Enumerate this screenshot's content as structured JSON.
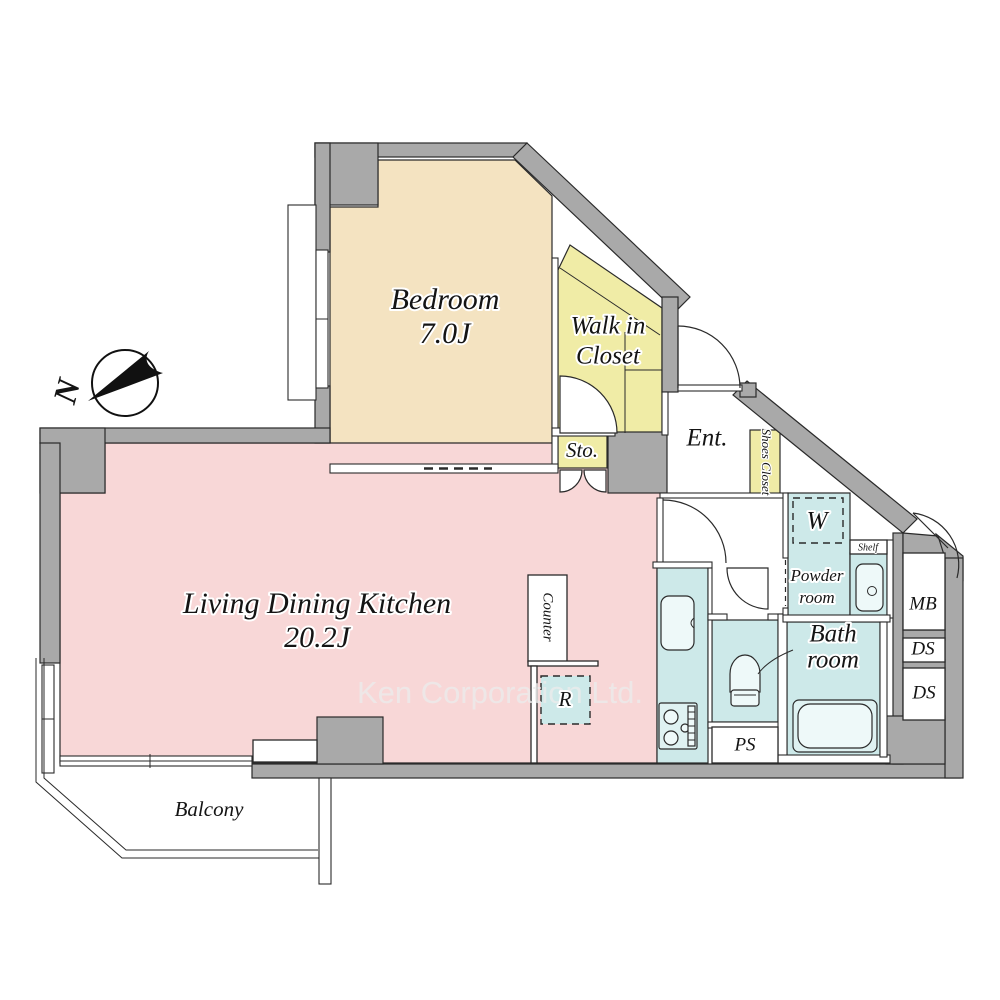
{
  "watermark": {
    "text": "Ken Corporation Ltd."
  },
  "compass": {
    "label": "N"
  },
  "rooms": {
    "bedroom": {
      "name": "Bedroom",
      "size": "7.0J"
    },
    "walk_in_closet": {
      "line1": "Walk in",
      "line2": "Closet"
    },
    "storage": {
      "label": "Sto."
    },
    "entrance": {
      "label": "Ent."
    },
    "shoes_closet": {
      "label": "Shoes Closet"
    },
    "washing_machine": {
      "label": "W"
    },
    "shelf": {
      "label": "Shelf"
    },
    "powder_room": {
      "line1": "Powder",
      "line2": "room"
    },
    "bathroom": {
      "line1": "Bath",
      "line2": "room"
    },
    "meter_box": {
      "label": "MB"
    },
    "duct_space_1": {
      "label": "DS"
    },
    "duct_space_2": {
      "label": "DS"
    },
    "pipe_space": {
      "label": "PS"
    },
    "counter": {
      "label": "Counter"
    },
    "refrigerator": {
      "label": "R"
    },
    "ldk": {
      "name": "Living Dining Kitchen",
      "size": "20.2J"
    },
    "balcony": {
      "label": "Balcony"
    }
  },
  "colors": {
    "wall": "#a9a9a9",
    "bedroom": "#f4e3c1",
    "closet_yellow": "#f0eca6",
    "ldk_pink": "#f8d7d7",
    "wet_cyan": "#cde9e9"
  }
}
